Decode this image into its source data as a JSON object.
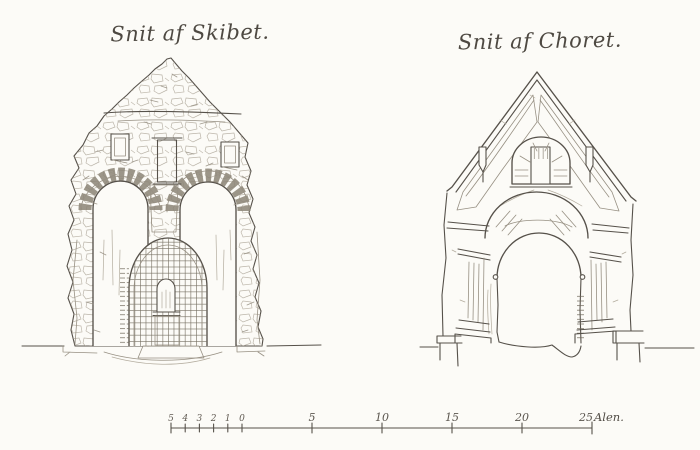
{
  "figures": {
    "left": {
      "title": "Snit af Skibet."
    },
    "right": {
      "title": "Snit af Choret."
    }
  },
  "scale_bar": {
    "minor_labels": [
      "5",
      "4",
      "3",
      "2",
      "1",
      "0"
    ],
    "major_labels": [
      "5",
      "10",
      "15",
      "20",
      "25"
    ],
    "unit_label": "Alen."
  },
  "palette": {
    "paper": "#fcfbf7",
    "ink": "#56514a",
    "ink_light": "#979083"
  }
}
